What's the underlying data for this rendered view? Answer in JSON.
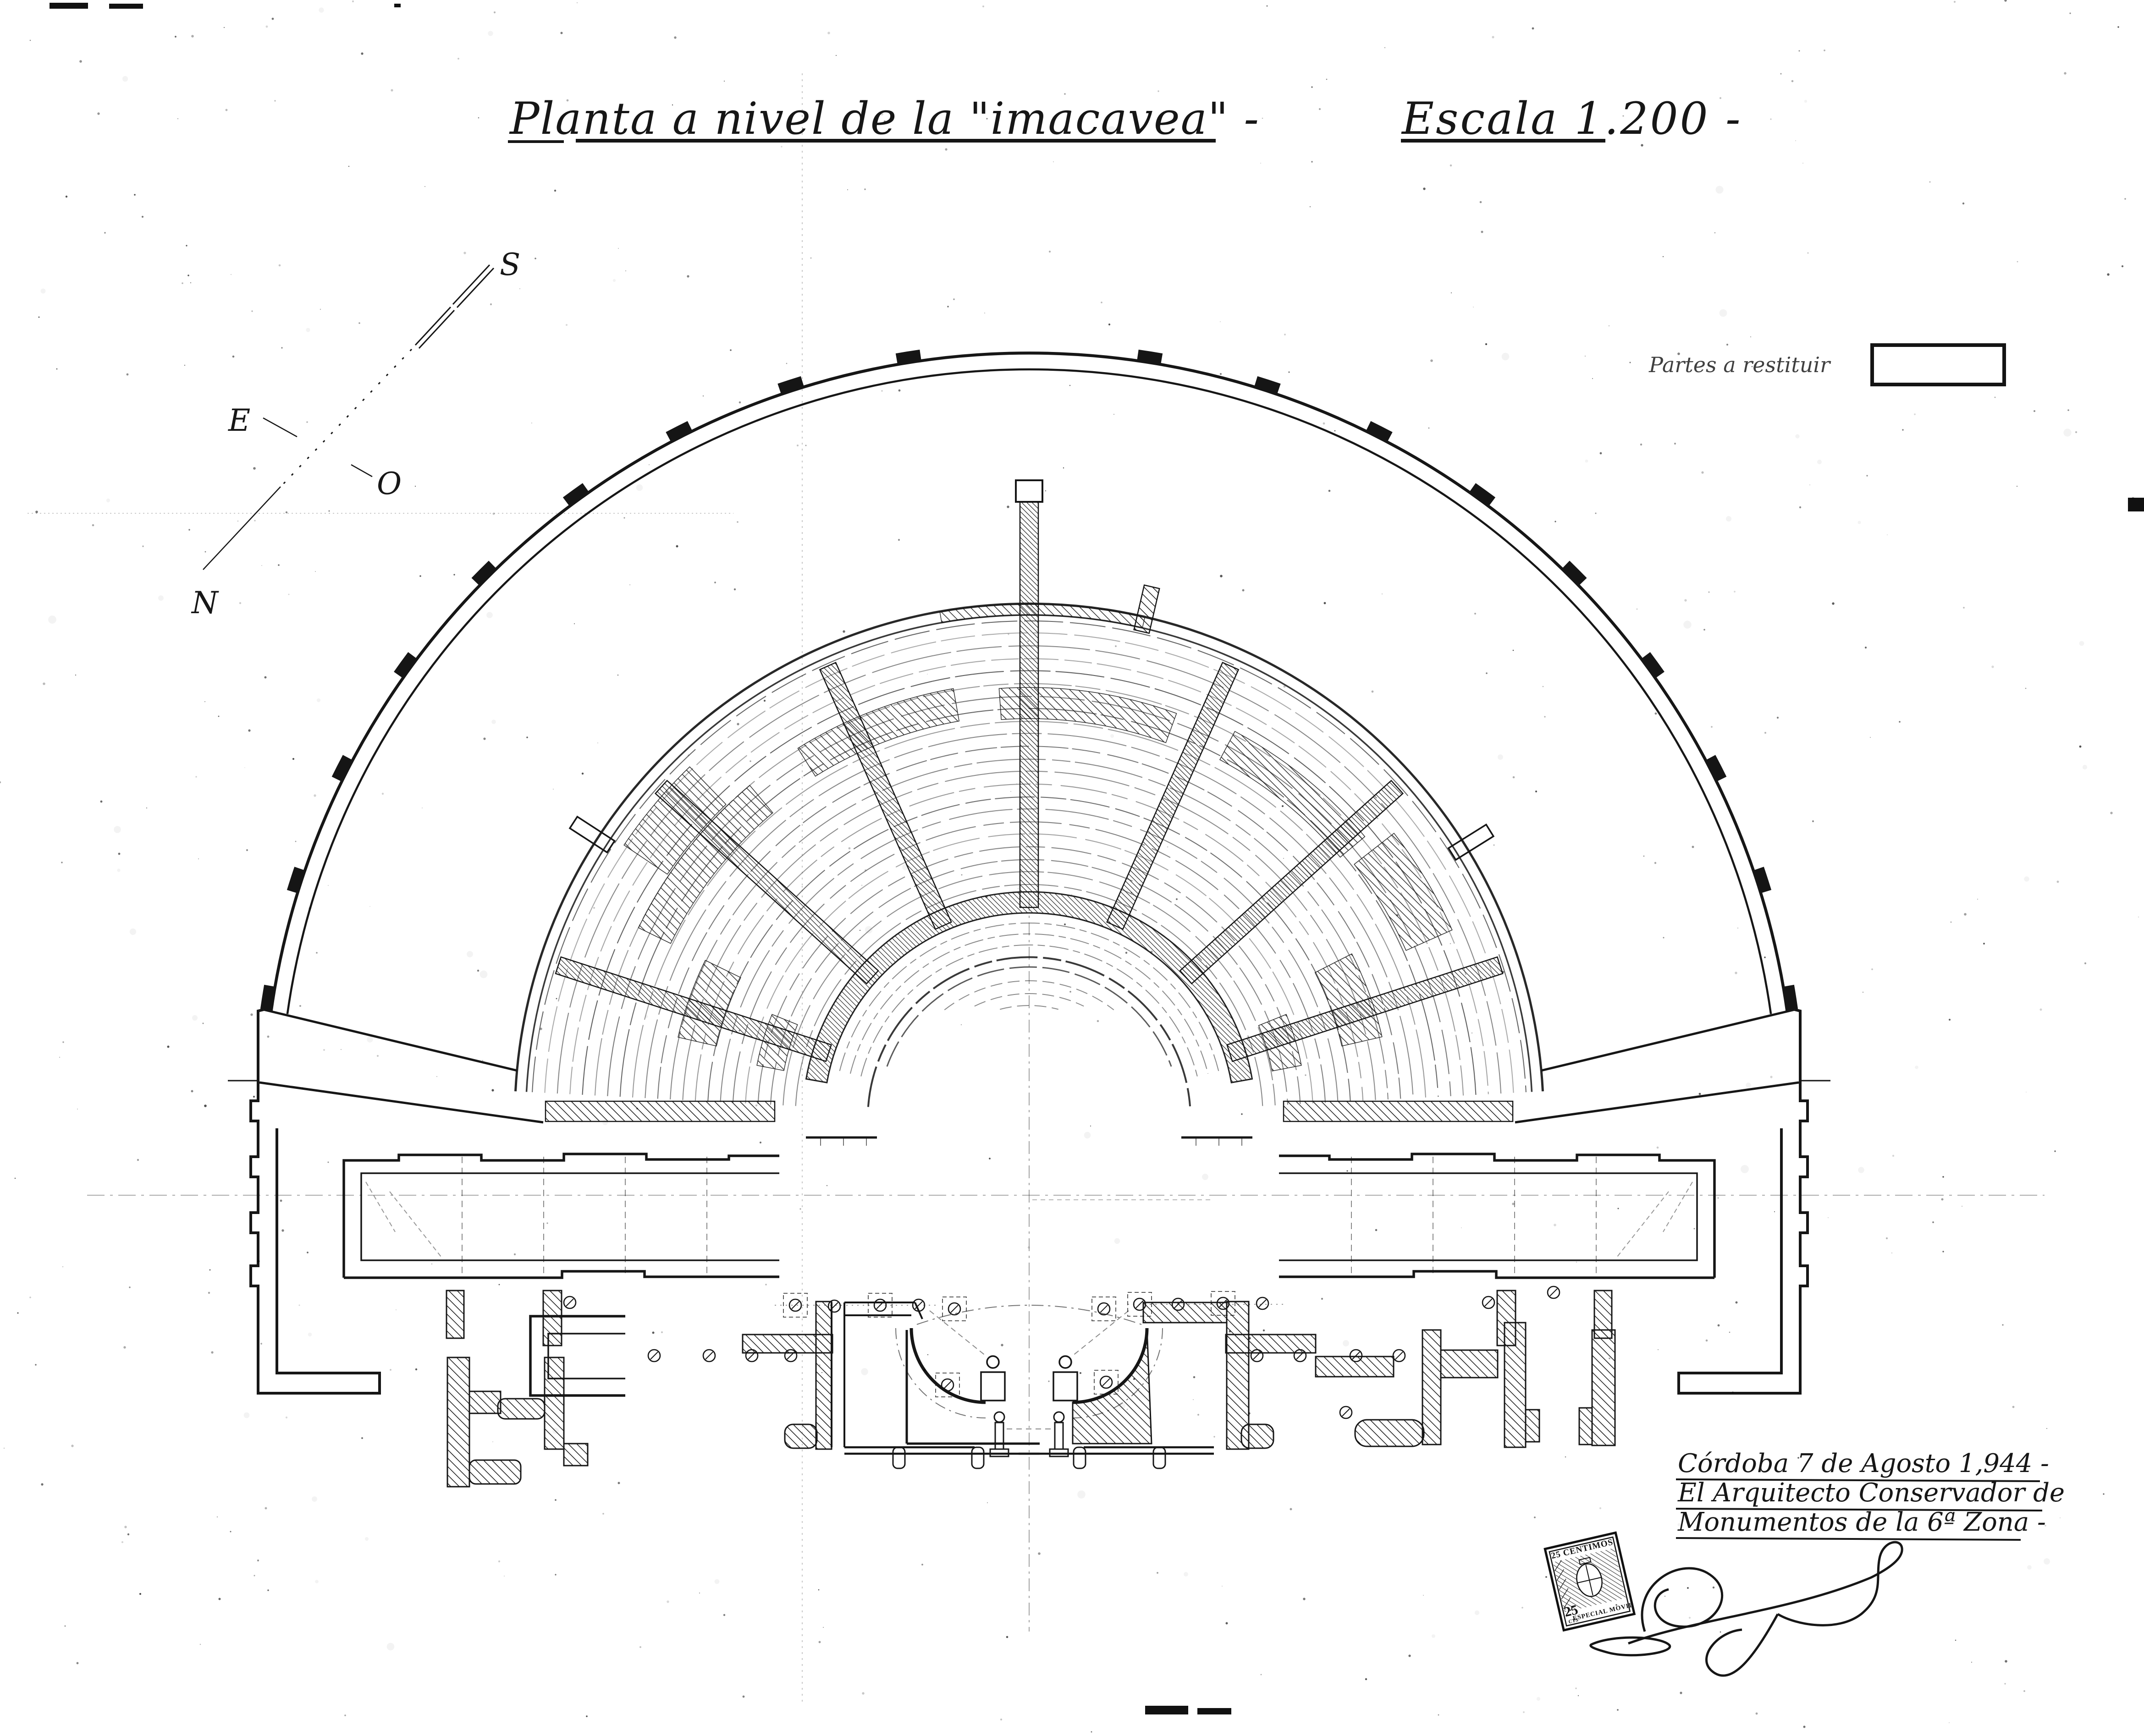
{
  "page": {
    "background": "#ffffff",
    "ink_color": "#161616",
    "kind": "scanned architectural plan"
  },
  "title": {
    "text": "Planta a nivel de la \"imacavea\" -"
  },
  "scale": {
    "text": "Escala 1.200 -"
  },
  "legend": {
    "label": "Partes a restituir"
  },
  "compass": {
    "south": "S",
    "east": "E",
    "west": "O",
    "north": "N"
  },
  "signature_block": {
    "line1": "Córdoba 7 de Agosto 1,944 -",
    "line2": "El Arquitecto Conservador de",
    "line3": "Monumentos de la 6ª Zona -"
  },
  "stamp": {
    "top": "25 CENTIMOS",
    "value": "25",
    "unit": "CTS",
    "bottom": "ESPECIAL MOVIL"
  }
}
